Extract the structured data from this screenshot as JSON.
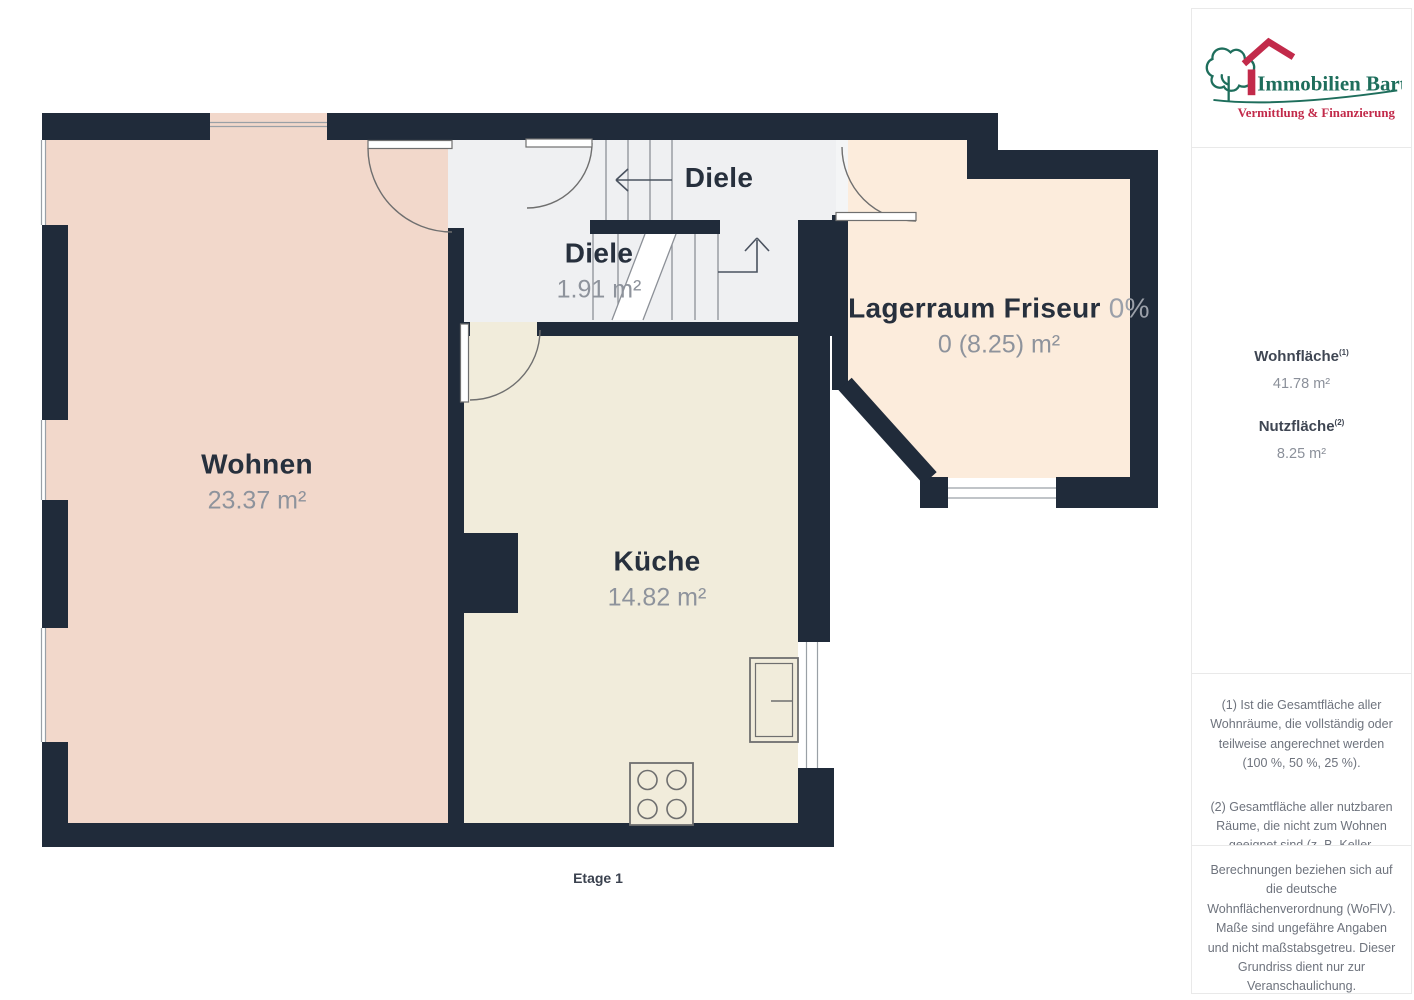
{
  "plan": {
    "floor_label": "Etage 1",
    "rooms": [
      {
        "name": "Wohnen",
        "area": "23.37 m²"
      },
      {
        "name": "Küche",
        "area": "14.82 m²"
      },
      {
        "name": "Diele"
      },
      {
        "name": "Diele",
        "area": "1.91 m²"
      },
      {
        "name": "Lagerraum Friseur",
        "share": "0%",
        "area": "0 (8.25) m²"
      }
    ],
    "colors": {
      "wall": "#202b3a",
      "wohnen_fill": "#f2d8cb",
      "kueche_fill": "#f1ecdb",
      "lagerraum_fill": "#fcecdc",
      "diele_fill": "#eff0f2"
    }
  },
  "sidebar": {
    "logo": {
      "name": "Immobilien Bart",
      "tagline": "Vermittlung & Finanzierung",
      "green": "#1e6e5c",
      "red": "#c22a4a"
    },
    "metrics": [
      {
        "label": "Wohnfläche",
        "footnote_ref": "(1)",
        "value": "41.78 m²"
      },
      {
        "label": "Nutzfläche",
        "footnote_ref": "(2)",
        "value": "8.25 m²"
      }
    ],
    "footnotes": {
      "note1": "(1) Ist die Gesamtfläche aller Wohnräume, die vollständig oder teilweise angerechnet werden (100 %, 50 %, 25 %).",
      "note2": "(2) Gesamtfläche aller nutzbaren Räume, die nicht zum Wohnen geeignet sind (z. B. Keller, Garage)."
    },
    "disclaimer": "Berechnungen beziehen sich auf die deutsche Wohnflächenverordnung (WoFlV). Maße sind ungefähre Angaben und nicht maßstabsgetreu. Dieser Grundriss dient nur zur Veranschaulichung.",
    "brand": {
      "primary": "GIRAFFE",
      "secondary": "360"
    }
  }
}
